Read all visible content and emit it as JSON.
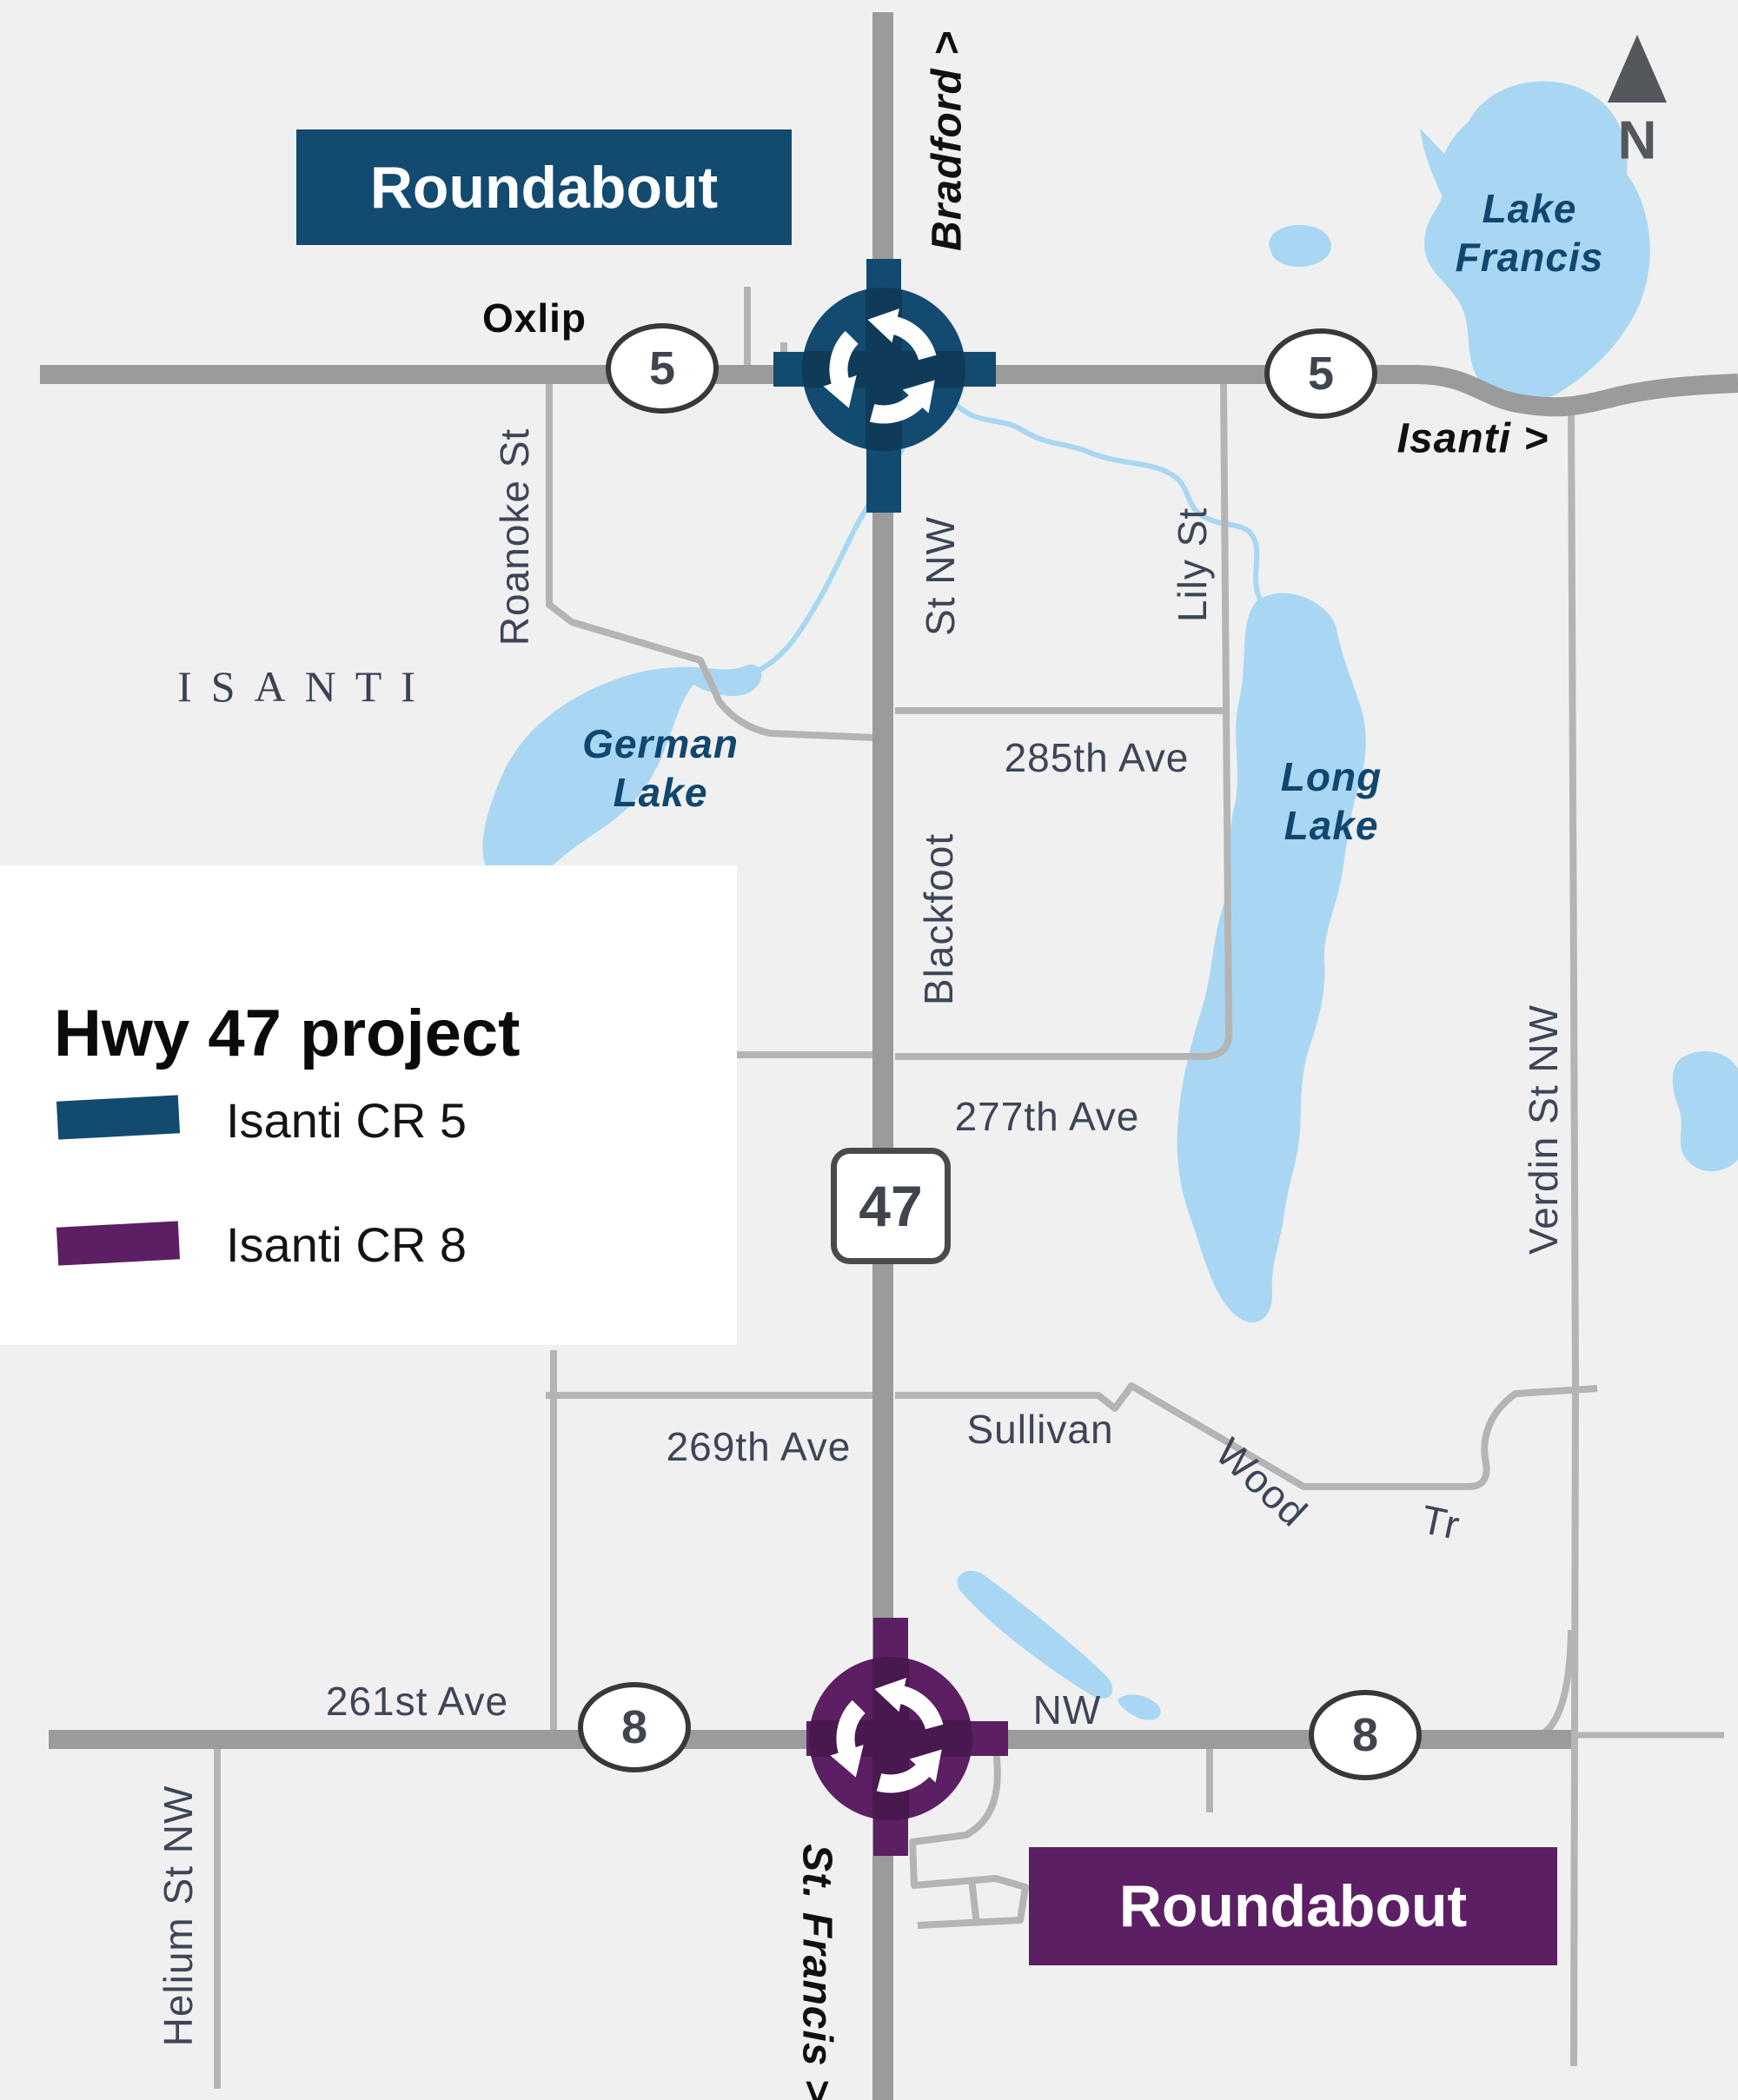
{
  "colors": {
    "background": "#f0f0f1",
    "road_major": "#9b9b9b",
    "road_minor": "#b4b4b4",
    "water": "#a9d7f3",
    "cr5_navy": "#134a70",
    "cr8_purple": "#5c1f63",
    "road_label": "#3d4556",
    "water_label": "#11476f",
    "compass_gray": "#54585c"
  },
  "legend": {
    "title": "Hwy 47 project",
    "items": [
      {
        "label": "Isanti CR 5",
        "color": "#134a70"
      },
      {
        "label": "Isanti CR 8",
        "color": "#5c1f63"
      }
    ]
  },
  "callouts": {
    "north": "Roundabout",
    "south": "Roundabout"
  },
  "compass": {
    "label": "N"
  },
  "county": "ISANTI",
  "shields": {
    "cr5_west": "5",
    "cr5_east": "5",
    "hwy47": "47",
    "cr8_west": "8",
    "cr8_east": "8"
  },
  "lakes": {
    "lake_francis": [
      "Lake",
      "Francis"
    ],
    "german_lake": [
      "German",
      "Lake"
    ],
    "long_lake": [
      "Long",
      "Lake"
    ]
  },
  "roads": {
    "bradford": "Bradford >",
    "oxlip": "Oxlip",
    "isanti_dir": "Isanti >",
    "roanoke": "Roanoke St",
    "st_nw": "St NW",
    "lily": "Lily St",
    "ave285": "285th Ave",
    "blackfoot": "Blackfoot",
    "ave277": "277th Ave",
    "verdin": "Verdin St NW",
    "ave269": "269th Ave",
    "sullivan": "Sullivan",
    "wood": "Wood",
    "tr": "Tr",
    "ave261": "261st Ave",
    "nw": "NW",
    "helium": "Helium St NW",
    "st_francis": "St. Francis >"
  }
}
